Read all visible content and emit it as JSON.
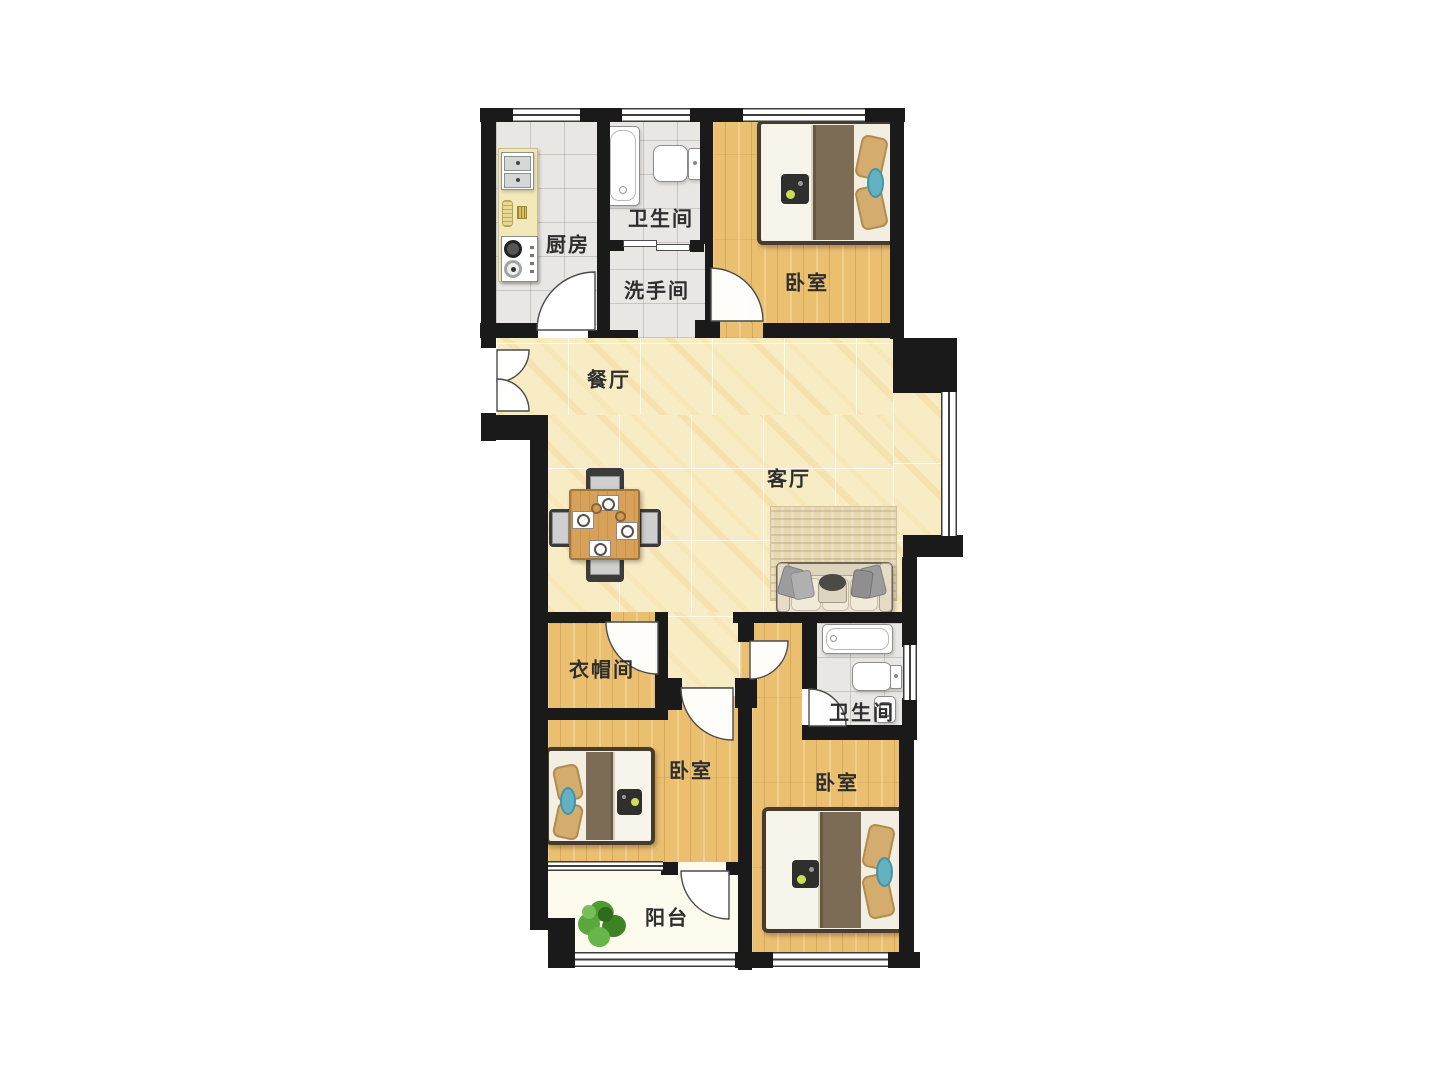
{
  "plan": {
    "title": "apartment-floor-plan",
    "colors": {
      "wall": "#1a1a1a",
      "wood": "#eabf70",
      "marble": "#f8ecc5",
      "tile": "#e9e7e3",
      "balcony": "#fcfbee",
      "label": "#2e2e2e",
      "bed-blanket": "#7d6c55",
      "bed-quilt": "#f7f4eb",
      "pillow": "#d3ac6e",
      "teal": "#64b1c2",
      "rug": "#e7d8b4",
      "sofa": "#ebe2cf",
      "table-wood": "#d7a159",
      "counter": "#f2e8ba",
      "plant": "#57a238"
    },
    "rooms": [
      {
        "id": "kitchen",
        "label": "厨房",
        "cx": 568,
        "cy": 243,
        "floor": "tile"
      },
      {
        "id": "bathroom-top",
        "label": "卫生间",
        "cx": 661,
        "cy": 217,
        "floor": "tile"
      },
      {
        "id": "washroom",
        "label": "洗手间",
        "cx": 657,
        "cy": 289,
        "floor": "tile"
      },
      {
        "id": "bedroom-top",
        "label": "卧室",
        "cx": 807,
        "cy": 281,
        "floor": "wood"
      },
      {
        "id": "dining-room",
        "label": "餐厅",
        "cx": 609,
        "cy": 378,
        "floor": "marble"
      },
      {
        "id": "living-room",
        "label": "客厅",
        "cx": 789,
        "cy": 477,
        "floor": "marble"
      },
      {
        "id": "cloakroom",
        "label": "衣帽间",
        "cx": 602,
        "cy": 668,
        "floor": "wood"
      },
      {
        "id": "bedroom-middle",
        "label": "卧室",
        "cx": 691,
        "cy": 769,
        "floor": "wood"
      },
      {
        "id": "bathroom-bottom",
        "label": "卫生间",
        "cx": 862,
        "cy": 711,
        "floor": "tile"
      },
      {
        "id": "bedroom-right",
        "label": "卧室",
        "cx": 837,
        "cy": 781,
        "floor": "wood"
      },
      {
        "id": "balcony",
        "label": "阳台",
        "cx": 667,
        "cy": 916,
        "floor": "balcony"
      }
    ],
    "furniture_icons": [
      {
        "name": "kitchen-counter-icon",
        "room": "kitchen"
      },
      {
        "name": "sink-icon",
        "room": "kitchen"
      },
      {
        "name": "stove-icon",
        "room": "kitchen"
      },
      {
        "name": "bathtub-icon",
        "room": "bathroom-top"
      },
      {
        "name": "toilet-icon",
        "room": "bathroom-top"
      },
      {
        "name": "double-bed-icon",
        "room": "bedroom-top"
      },
      {
        "name": "dining-table-icon",
        "room": "dining-room"
      },
      {
        "name": "chair-icon",
        "room": "dining-room"
      },
      {
        "name": "sofa-icon",
        "room": "living-room"
      },
      {
        "name": "rug-icon",
        "room": "living-room"
      },
      {
        "name": "double-bed-icon",
        "room": "bedroom-middle"
      },
      {
        "name": "bathtub-icon",
        "room": "bathroom-bottom"
      },
      {
        "name": "toilet-icon",
        "room": "bathroom-bottom"
      },
      {
        "name": "washbasin-icon",
        "room": "bathroom-bottom"
      },
      {
        "name": "double-bed-icon",
        "room": "bedroom-right"
      },
      {
        "name": "potted-plant-icon",
        "room": "balcony"
      }
    ]
  }
}
